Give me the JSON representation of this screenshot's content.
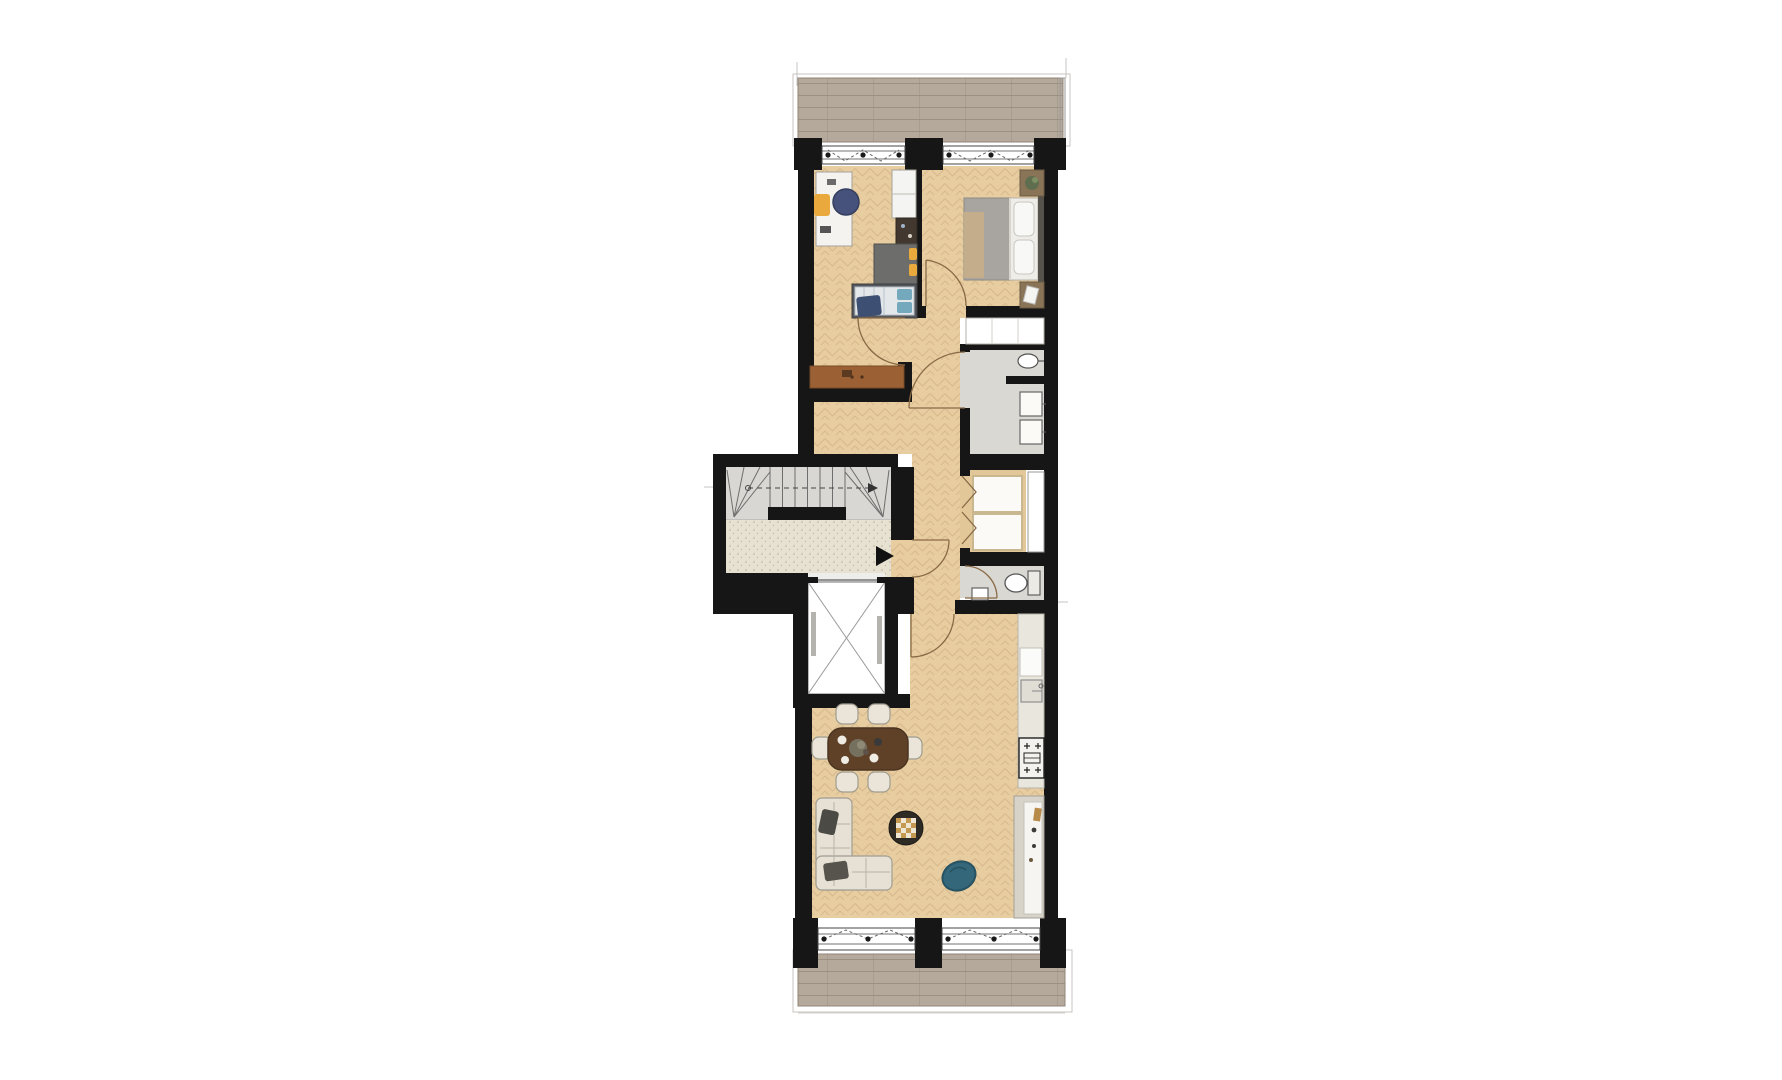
{
  "scene": {
    "kind": "apartment-floor-plan",
    "background": "#ffffff"
  },
  "colors": {
    "wall": "#161616",
    "marker_black": "#111111",
    "floor_wood": "#e7cda0",
    "floor_wood_line": "#c7a677",
    "balcony_wood": "#b5a99b",
    "balcony_wood_line": "#998d80",
    "lobby_floor": "#e6e1d0",
    "lobby_speckle": "#b9b19c",
    "stair_floor": "#d8d7d3",
    "stair_line": "#6e6e6e",
    "tile_floor": "#d9d8d3",
    "counter": "#e9e6de",
    "white_fixture": "#fbfaf7",
    "door_arc": "#8a6a46",
    "accent_yellow": "#e9a93d",
    "accent_navy": "#46527c",
    "accent_teal": "#34677a",
    "sofa_cream": "#e6e1d4",
    "table_brown": "#5f4128",
    "sideboard_brown": "#9b6134",
    "bed_duvet_gray": "#a8a5a0",
    "outline_gray": "#c9c6c0"
  },
  "icons": {
    "entrance_arrow": "right-pointing-triangle",
    "stair_direction": "zigzag-arrow",
    "door_swing": "quarter-arc",
    "window_hinge": "dot-with-dashed-zigzag",
    "elevator": "crossed-box"
  },
  "rooms": [
    {
      "id": "balcony-top"
    },
    {
      "id": "bedroom-1"
    },
    {
      "id": "bedroom-2"
    },
    {
      "id": "hallway"
    },
    {
      "id": "bathroom"
    },
    {
      "id": "utility-closet"
    },
    {
      "id": "duct-shaft"
    },
    {
      "id": "toilet"
    },
    {
      "id": "living-room"
    },
    {
      "id": "kitchen"
    },
    {
      "id": "stairwell"
    },
    {
      "id": "elevator"
    },
    {
      "id": "lobby"
    },
    {
      "id": "meter-closets"
    },
    {
      "id": "balcony-bottom"
    }
  ],
  "furniture": [
    "desk",
    "desk-chair",
    "lounge-pod-chair",
    "wardrobe",
    "shelf-unit",
    "single-bed",
    "sideboard",
    "double-bed",
    "nightstand",
    "built-in-closet",
    "washbasin",
    "washer",
    "dryer",
    "toilet-bowl",
    "hand-basin",
    "kitchen-counter",
    "kitchen-sink",
    "cooktop",
    "tall-cabinet",
    "dining-table",
    "dining-chair",
    "corner-sofa",
    "coffee-table",
    "bean-chair"
  ]
}
